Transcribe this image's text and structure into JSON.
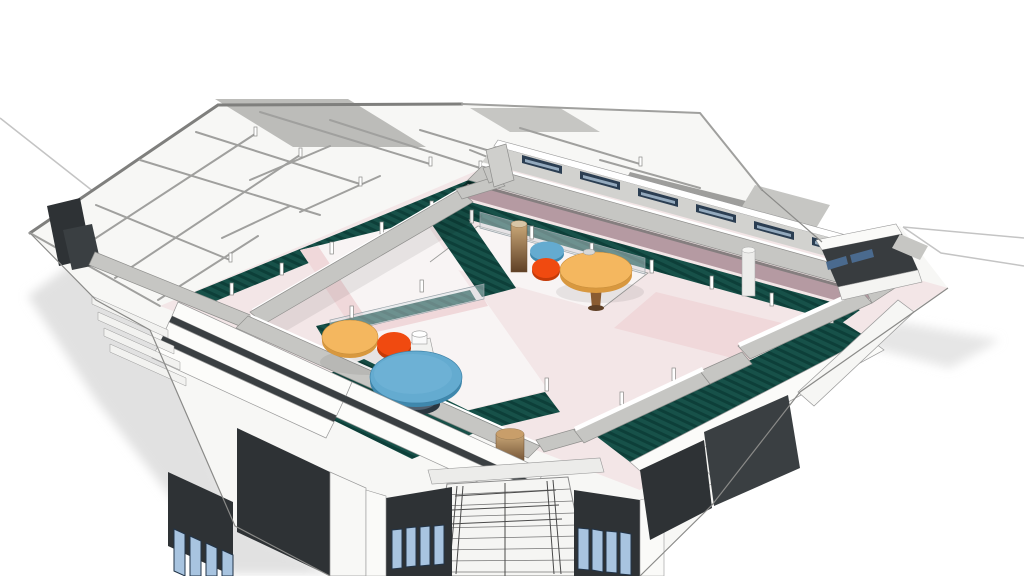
{
  "scene": {
    "type": "3d-architectural-model-rendering",
    "style": "sketchup-like-cutaway-axonometric",
    "description": "Aerial cutaway 3D rendering of a building interior: a large atrium ringed by an elevated grey walkway loop, dark teal floor corridors, pink floor islands with round cafe tables (orange, red and blue), timber columns, perimeter rooms with white walls, a clerestory window wall, dark facade panels with blue glazing and a central entrance staircase",
    "background": "#ffffff",
    "colors": {
      "bg": "#ffffff",
      "wall_white": "#f7f7f5",
      "wall_line": "#a0a09e",
      "wall_gray": "#bcbcb9",
      "wall_gray_dark": "#9e9e9c",
      "wall_charcoal": "#2e3235",
      "wall_charcoal2": "#3a3f42",
      "roof_gray": "#c6c6c3",
      "floor_pink": "#f3e6e7",
      "floor_pink_strong": "#f0d8da",
      "floor_white": "#f8f4f4",
      "teal": "#175149",
      "teal_dark": "#0d3f39",
      "mauve": "#b59aa2",
      "walkway": "#c6c6c3",
      "walkway_edge": "#ffffff",
      "window_dark": "#2b3e52",
      "window_streak": "#93a9bd",
      "window_glass": "#a8c4e0",
      "window_frame": "#223448",
      "table_orange": "#f4b75f",
      "table_orange_dark": "#d8983f",
      "table_red": "#f04a10",
      "table_red_dark": "#c43a08",
      "table_blue": "#64abd0",
      "table_blue_dark": "#3f88ad",
      "column_brown": "#8a5c32",
      "column_brown_light": "#caa878",
      "column_dark": "#5f4026",
      "shadow": "#dcdcdc",
      "site_line": "#c4c4c4",
      "glass_fill": "#d7e0e5",
      "rail": "#4a4a4a"
    },
    "objects": {
      "left_table_group": [
        "orange-round-table",
        "red-round-table",
        "blue-round-table-large",
        "white-bin"
      ],
      "right_table_group": [
        "blue-round-table-small",
        "red-round-table-small",
        "orange-round-table",
        "grey-cup"
      ],
      "columns": [
        "timber-column-north",
        "timber-column-south",
        "white-column-east"
      ],
      "features": [
        "perimeter-rooms-north",
        "clerestory-window-wall-northeast",
        "elevated-walkway-loop",
        "teal-floor-corridors",
        "pink-floor-islands",
        "entrance-staircase-south",
        "dark-facade-panels-with-glazing",
        "exterior-side-stairs-west",
        "site-outline-lines",
        "drop-shadows"
      ]
    }
  }
}
